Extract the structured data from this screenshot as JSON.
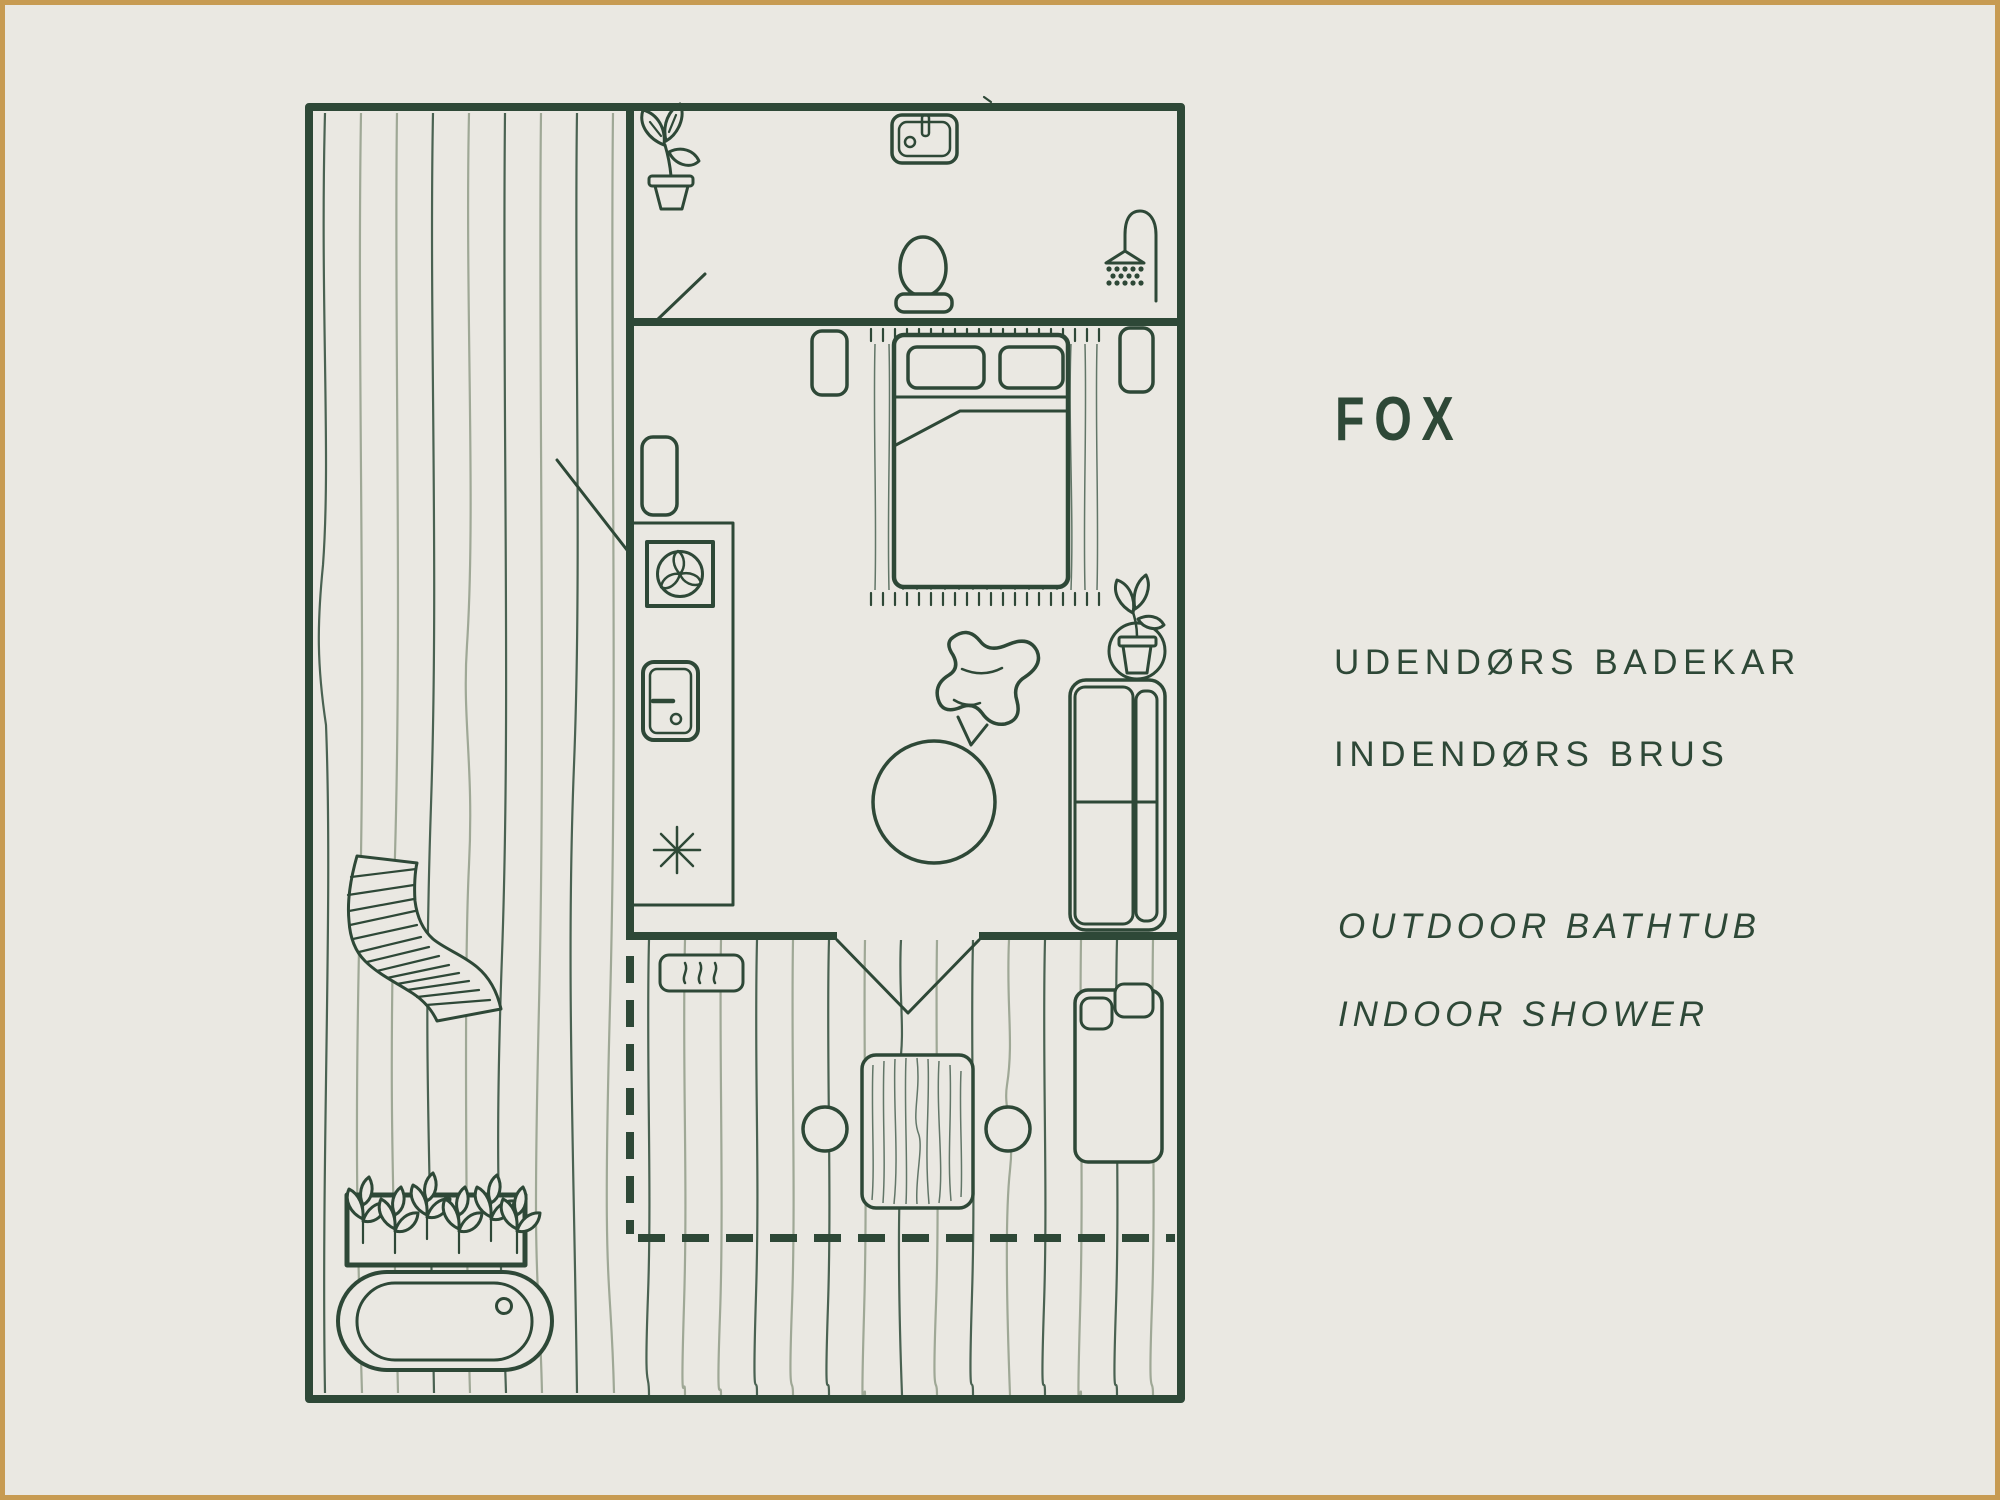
{
  "colors": {
    "background": "#EAE8E2",
    "frame": "#C79B52",
    "ink": "#2E4837",
    "wood_light": "#9FA896",
    "wood_dark": "#4A6252"
  },
  "panel": {
    "title": "FOX",
    "features_da": [
      "UDENDØRS BADEKAR",
      "INDENDØRS BRUS"
    ],
    "features_en": [
      "OUTDOOR BATHTUB",
      "INDOOR SHOWER"
    ]
  },
  "floor_plan": {
    "rooms": [
      "side-deck",
      "bathroom",
      "bedroom",
      "rear-deck"
    ],
    "elements": [
      "potted-plant-icon",
      "sink-icon",
      "toilet-icon",
      "shower-icon",
      "door-swing",
      "wardrobe",
      "ventilation-fan-icon",
      "mini-fridge-icon",
      "asterisk-symbol",
      "bed-with-pillows",
      "rug",
      "nightstand",
      "butterfly-chair",
      "ottoman",
      "plant-stand-icon",
      "sofa",
      "heater-icon",
      "wood-table",
      "stool",
      "bath-mat",
      "soap",
      "lounge-chair",
      "planter-box",
      "bathtub",
      "dashed-roof-line"
    ]
  }
}
